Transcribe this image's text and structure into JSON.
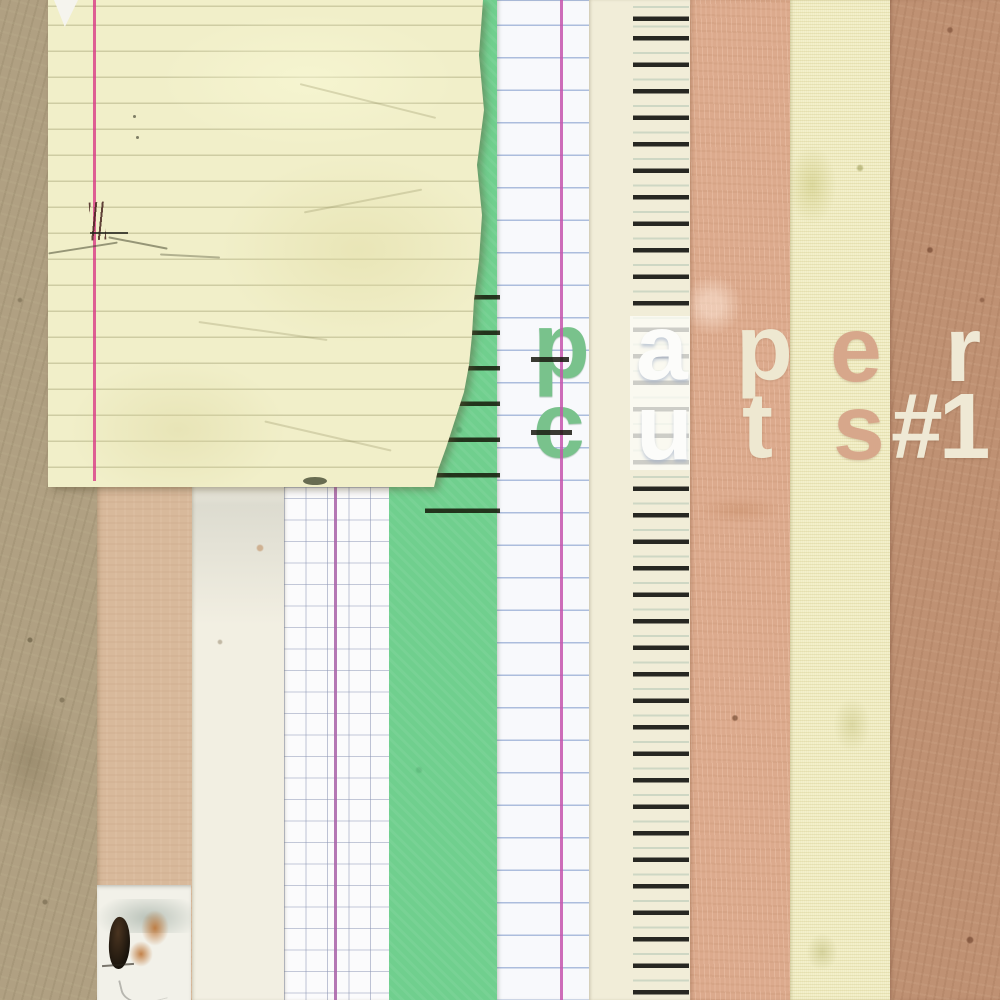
{
  "artwork": {
    "title": "paper cuts #1",
    "words": {
      "word1": "paper",
      "word2": "cuts",
      "issue": "#1"
    },
    "letters": {
      "row1": [
        {
          "char": "p",
          "strip": "white-ruled-notebook",
          "color": "#79c28c"
        },
        {
          "char": "a",
          "strip": "cream-ledger",
          "color": "#fcfcfa"
        },
        {
          "char": "p",
          "strip": "salmon-kraft",
          "color": "#eee8d1"
        },
        {
          "char": "e",
          "strip": "canvas",
          "color": "#d7a78b"
        },
        {
          "char": "r",
          "strip": "brown-kraft",
          "color": "#efe9d5"
        }
      ],
      "row2": [
        {
          "char": "c",
          "strip": "white-ruled-notebook",
          "color": "#79c28c"
        },
        {
          "char": "u",
          "strip": "cream-ledger",
          "color": "#fcfcfa"
        },
        {
          "char": "t",
          "strip": "salmon-kraft",
          "color": "#eee8d1"
        },
        {
          "char": "s",
          "strip": "canvas",
          "color": "#d7a78b"
        },
        {
          "char": "#1",
          "strip": "brown-kraft",
          "color": "#efe9d5"
        }
      ]
    },
    "strips": [
      {
        "name": "kraft-background",
        "color": "#b0a082"
      },
      {
        "name": "tan-paper",
        "color": "#d8b99b"
      },
      {
        "name": "cream-paper",
        "color": "#f2efe2"
      },
      {
        "name": "graph-paper",
        "color": "#fbfbfc",
        "grid_color": "#8a94b2",
        "margin_line_color": "#a75fa7"
      },
      {
        "name": "green-paper",
        "color": "#70cf8e"
      },
      {
        "name": "white-ruled-notebook",
        "color": "#f8f9fc",
        "rule_color": "#6e8cc3",
        "margin_line_color": "#c653ad"
      },
      {
        "name": "cream-ledger",
        "color": "#f1edd8",
        "tick_color": "#161612"
      },
      {
        "name": "salmon-kraft",
        "color": "#dcaa8d"
      },
      {
        "name": "canvas",
        "color": "#f3f0cc"
      },
      {
        "name": "brown-kraft",
        "color": "#bf9173"
      }
    ],
    "notepad": {
      "name": "torn-yellow-legal-pad",
      "color": "#f1efc9",
      "rule_color": "#96946a",
      "margin_line_color": "#d93a86"
    }
  }
}
